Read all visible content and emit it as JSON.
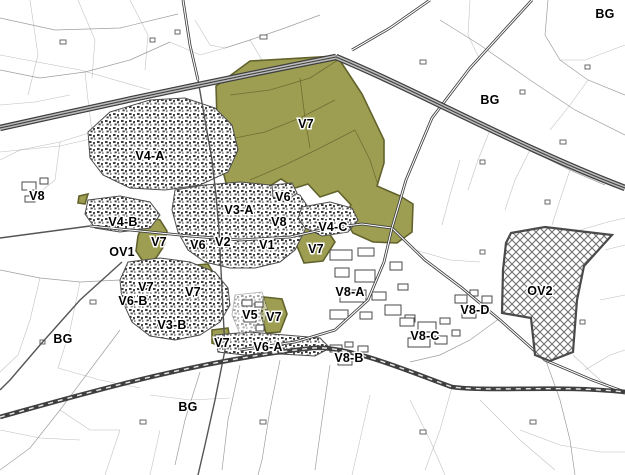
{
  "map": {
    "width": 625,
    "height": 475,
    "colors": {
      "background": "#ffffff",
      "parcel_line": "#7d7d7d",
      "road_dark": "#3f3f3f",
      "zone_fill": "#9e9e52",
      "zone_outline": "#62622c",
      "hatch_line": "#707070",
      "label_text": "#000000",
      "label_halo": "#ffffff"
    },
    "legend_note": "",
    "labels": [
      {
        "text": "BG",
        "x": 605,
        "y": 14
      },
      {
        "text": "BG",
        "x": 490,
        "y": 100
      },
      {
        "text": "V4-A",
        "x": 150,
        "y": 156
      },
      {
        "text": "V8",
        "x": 37,
        "y": 196
      },
      {
        "text": "V7",
        "x": 306,
        "y": 124
      },
      {
        "text": "V6",
        "x": 283,
        "y": 197
      },
      {
        "text": "V3-A",
        "x": 239,
        "y": 210
      },
      {
        "text": "V8",
        "x": 279,
        "y": 222
      },
      {
        "text": "V4-C",
        "x": 333,
        "y": 227
      },
      {
        "text": "V4-B",
        "x": 123,
        "y": 222
      },
      {
        "text": "OV1",
        "x": 122,
        "y": 252
      },
      {
        "text": "V7",
        "x": 159,
        "y": 242
      },
      {
        "text": "V6",
        "x": 198,
        "y": 245
      },
      {
        "text": "V2",
        "x": 223,
        "y": 242
      },
      {
        "text": "V1",
        "x": 267,
        "y": 245
      },
      {
        "text": "V7",
        "x": 316,
        "y": 249
      },
      {
        "text": "V7",
        "x": 146,
        "y": 287
      },
      {
        "text": "V6-B",
        "x": 133,
        "y": 301
      },
      {
        "text": "V7",
        "x": 193,
        "y": 292
      },
      {
        "text": "V3-B",
        "x": 172,
        "y": 325
      },
      {
        "text": "BG",
        "x": 63,
        "y": 339
      },
      {
        "text": "V5",
        "x": 250,
        "y": 315
      },
      {
        "text": "V7",
        "x": 274,
        "y": 317
      },
      {
        "text": "V7",
        "x": 222,
        "y": 343
      },
      {
        "text": "V6-A",
        "x": 268,
        "y": 347
      },
      {
        "text": "V8-A",
        "x": 350,
        "y": 292
      },
      {
        "text": "V8-B",
        "x": 349,
        "y": 358
      },
      {
        "text": "V8-C",
        "x": 425,
        "y": 336
      },
      {
        "text": "V8-D",
        "x": 475,
        "y": 310
      },
      {
        "text": "OV2",
        "x": 540,
        "y": 291
      },
      {
        "text": "BG",
        "x": 188,
        "y": 407
      }
    ]
  }
}
